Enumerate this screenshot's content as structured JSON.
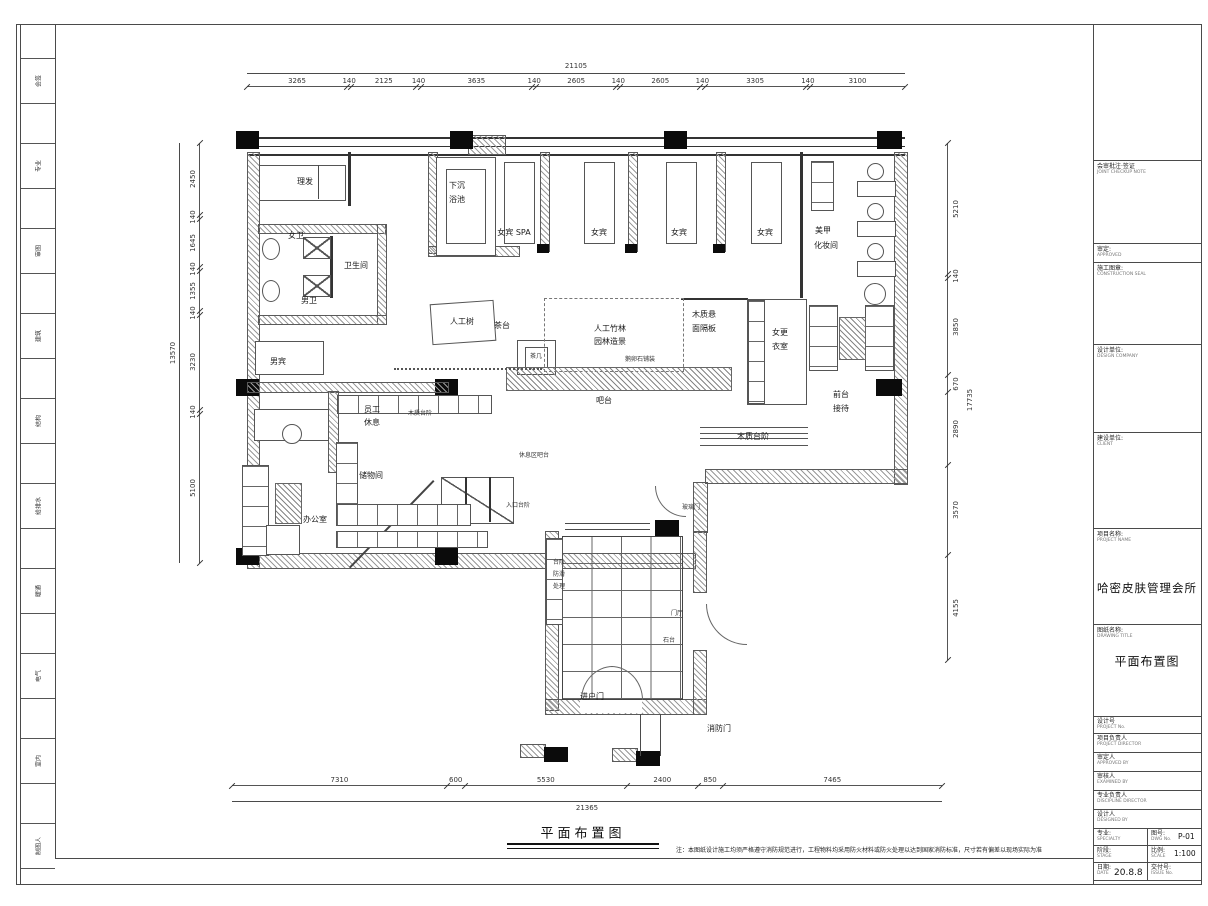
{
  "sheet": {
    "title": "平面布置图",
    "note": "注：本图纸设计施工均须严格遵守消防规范进行，工程物料均采用防火材料或防火处理以达到国家消防标准，尺寸若有偏差以现场实际为准"
  },
  "left_strip": {
    "labels": [
      "会签",
      "专业",
      "审图",
      "建筑",
      "结构",
      "给排水",
      "暖通",
      "电气",
      "室内",
      "制图人"
    ]
  },
  "dims": {
    "top": {
      "segments": [
        "3265",
        "140",
        "2125",
        "140",
        "3635",
        "140",
        "2605",
        "140",
        "2605",
        "140",
        "3305",
        "140",
        "3100"
      ],
      "total": "21105"
    },
    "left": {
      "segments": [
        "2450",
        "140",
        "1645",
        "140",
        "1355",
        "140",
        "3230",
        "140",
        "5100"
      ],
      "total": "13570"
    },
    "right": {
      "segments": [
        "5210",
        "140",
        "3850",
        "670",
        "2890",
        "3570",
        "4155"
      ],
      "total": "17735"
    },
    "bottom": {
      "segments": [
        "7310",
        "600",
        "5530",
        "2400",
        "850",
        "7465"
      ],
      "total": "21365"
    }
  },
  "plan": {
    "labels": {
      "barber": "理发",
      "toilet_f": "女卫",
      "toilet": "卫生间",
      "toilet_m": "男卫",
      "male_guest": "男宾",
      "pool1": "下沉",
      "pool2": "浴池",
      "spa": "女宾 SPA",
      "guest1": "女宾",
      "guest2": "女宾",
      "guest3": "女宾",
      "nail1": "美甲",
      "nail2": "化妆间",
      "tree": "人工树",
      "tea": "茶台",
      "tea_table": "茶几",
      "bamboo1": "人工竹林",
      "bamboo2": "园林造景",
      "panel1": "木质悬",
      "panel2": "面隔板",
      "bar": "吧台",
      "steps_right": "木质台阶",
      "steps_left": "木质台阶",
      "pebble": "鹅卵石铺装",
      "lounge_bar": "休息区吧台",
      "entry_steps": "入口台阶",
      "dressing1": "女更",
      "dressing2": "衣室",
      "reception1": "前台",
      "reception2": "接待",
      "staff1": "员工",
      "staff2": "休息",
      "storage": "储物间",
      "office": "办公室",
      "antislip1": "台阶",
      "antislip2": "防滑",
      "antislip3": "处理",
      "foyer": "门厅",
      "stone": "石台",
      "entry_door": "进户门",
      "fire_door": "消防门",
      "glass_door": "玻璃门"
    }
  },
  "title_block": {
    "review_label": "会审批注·签证",
    "review_sub": "JOINT CHECKUP NOTE",
    "approve_label": "审定:",
    "approve_sub": "APPROVED",
    "seal_label": "施工图章:",
    "seal_sub": "CONSTRUCTION SEAL",
    "firm_label": "设计单位:",
    "firm_sub": "DESIGN COMPANY",
    "client_label": "建设单位:",
    "client_sub": "CLIENT",
    "project_label": "项目名称:",
    "project_sub": "PROJECT NAME",
    "project_name": "哈密皮肤管理会所",
    "drawing_label": "图纸名称:",
    "drawing_sub": "DRAWING TITLE",
    "drawing_name": "平面布置图",
    "design_no_label": "设计号",
    "design_no_sub": "PROJECT No.",
    "fields": [
      {
        "label": "项目负责人",
        "sub": "PROJECT DIRECTOR"
      },
      {
        "label": "审定人",
        "sub": "APPROVED BY"
      },
      {
        "label": "审核人",
        "sub": "EXAMINED BY"
      },
      {
        "label": "专业负责人",
        "sub": "DISCIPLINE DIRECTOR"
      },
      {
        "label": "设计人",
        "sub": "DESIGNED BY"
      }
    ],
    "grid": {
      "spec_label": "专业:",
      "spec_sub": "SPECIALTY",
      "no_label": "图号:",
      "no_sub": "DWG No.",
      "no_value": "P-01",
      "stage_label": "阶段:",
      "stage_sub": "STAGE",
      "scale_label": "比例:",
      "scale_sub": "SCALE",
      "scale_value": "1:100",
      "date_label": "日期:",
      "date_sub": "DATE",
      "date_value": "20.8.8",
      "delivery_label": "交付号:",
      "delivery_sub": "ISSUE No."
    }
  }
}
